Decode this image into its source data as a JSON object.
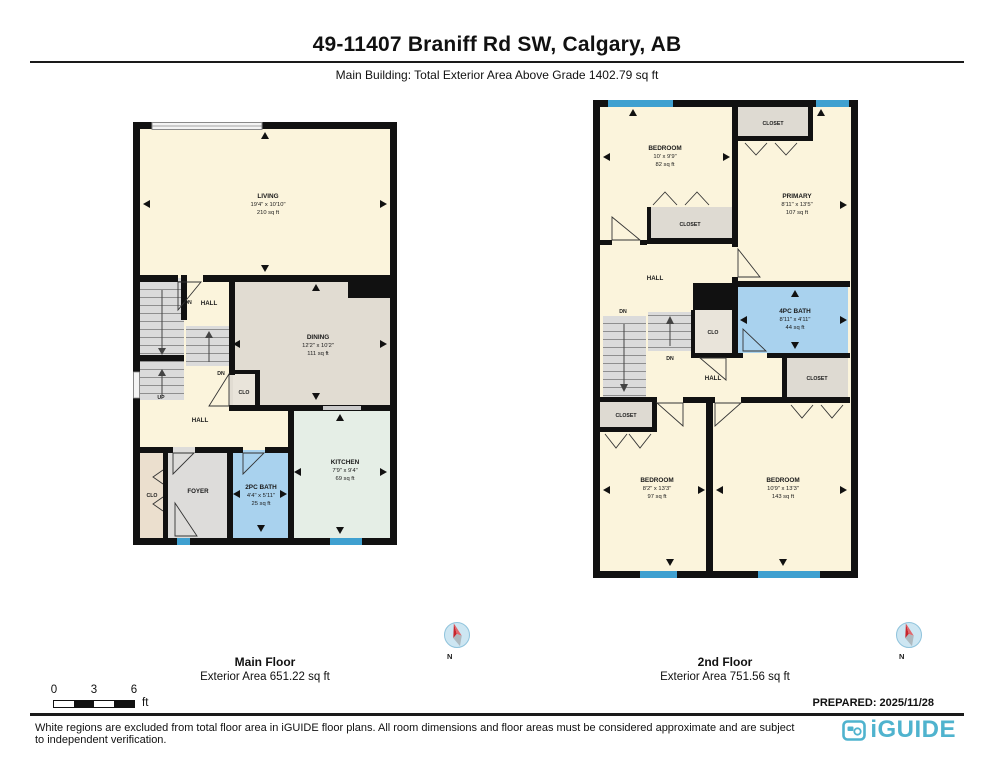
{
  "header": {
    "title": "49-11407 Braniff Rd SW, Calgary, AB",
    "subtitle": "Main Building: Total Exterior Area Above Grade 1402.79 sq ft"
  },
  "main_floor": {
    "caption_title": "Main Floor",
    "caption_area": "Exterior Area 651.22 sq ft",
    "compass": "N",
    "rooms": {
      "living": {
        "name": "LIVING",
        "dims": "19'4\" x 10'10\"",
        "area": "210 sq ft"
      },
      "dining": {
        "name": "DINING",
        "dims": "12'2\" x 10'2\"",
        "area": "111 sq ft"
      },
      "kitchen": {
        "name": "KITCHEN",
        "dims": "7'9\" x 9'4\"",
        "area": "69 sq ft"
      },
      "bath2pc": {
        "name": "2PC BATH",
        "dims": "4'4\" x 5'11\"",
        "area": "25 sq ft"
      },
      "foyer": {
        "name": "FOYER"
      },
      "clo_left": {
        "name": "CLO"
      },
      "clo_mid": {
        "name": "CLO"
      }
    },
    "labels": {
      "hall_upper": "HALL",
      "hall_lower": "HALL",
      "dn_upper": "DN",
      "dn_mid": "DN",
      "up": "UP"
    }
  },
  "second_floor": {
    "caption_title": "2nd Floor",
    "caption_area": "Exterior Area 751.56 sq ft",
    "compass": "N",
    "rooms": {
      "bedroom_top": {
        "name": "BEDROOM",
        "dims": "10' x 9'9\"",
        "area": "82 sq ft"
      },
      "primary": {
        "name": "PRIMARY",
        "dims": "8'11\" x 13'5\"",
        "area": "107 sq ft"
      },
      "bath4pc": {
        "name": "4PC BATH",
        "dims": "8'11\" x 4'11\"",
        "area": "44 sq ft"
      },
      "bedroom_left": {
        "name": "BEDROOM",
        "dims": "8'2\" x 13'3\"",
        "area": "97 sq ft"
      },
      "bedroom_right": {
        "name": "BEDROOM",
        "dims": "10'9\" x 13'3\"",
        "area": "143 sq ft"
      },
      "closet_top": {
        "name": "CLOSET"
      },
      "closet_mid": {
        "name": "CLOSET"
      },
      "closet_right": {
        "name": "CLOSET"
      },
      "closet_bl": {
        "name": "CLOSET"
      },
      "clo": {
        "name": "CLO"
      }
    },
    "labels": {
      "hall_upper": "HALL",
      "hall_lower": "HALL",
      "dn_left": "DN",
      "dn_mid": "DN"
    }
  },
  "scale_bar": {
    "t0": "0",
    "t3": "3",
    "t6": "6",
    "unit": "ft"
  },
  "footer": {
    "prepared": "PREPARED: 2025/11/28",
    "disclaimer": "White regions are excluded from total floor area in iGUIDE floor plans. All room dimensions and floor areas must be considered approximate and are subject to independent verification.",
    "brand": "iGUIDE"
  },
  "colors": {
    "wall": "#111111",
    "room_cream": "#FBF4DC",
    "dining_tan": "#E1DCD2",
    "kitchen_mint": "#E5EEE6",
    "bath_blue": "#A9D2EE",
    "closet_gray": "#DEDAD2",
    "clo_tan": "#EBDFCE",
    "window_blue": "#3FA0D0",
    "brand_blue": "#4FB3CE"
  }
}
